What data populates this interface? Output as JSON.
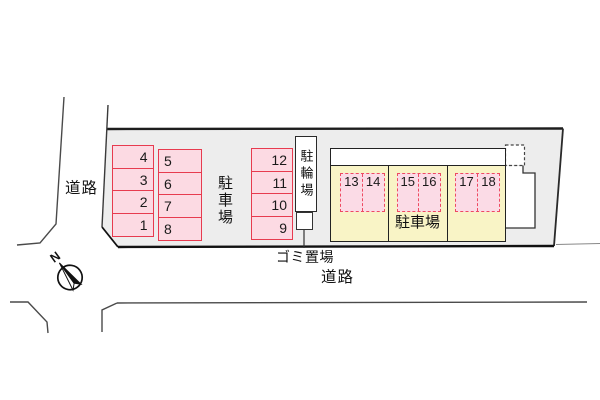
{
  "plan": {
    "road_label_left": "道路",
    "road_label_bottom": "道路",
    "main_parking_label": "駐車場",
    "building_parking_label": "駐車場",
    "bicycle_parking_label": "駐輪場",
    "garbage_area_label": "ゴミ置場",
    "compass_north": "N"
  },
  "spaces": {
    "col_a": [
      "4",
      "3",
      "2",
      "1"
    ],
    "col_b": [
      "5",
      "6",
      "7",
      "8"
    ],
    "col_c": [
      "12",
      "11",
      "10",
      "9"
    ],
    "building": [
      "13",
      "14",
      "15",
      "16",
      "17",
      "18"
    ]
  },
  "colors": {
    "site_fill": "#ededed",
    "stall_fill": "#fcdae3",
    "stall_border": "#e73b4f",
    "dashed_stall_border": "#ee4a62",
    "building_fill": "#f9f4c6",
    "outline": "#1d1d1d"
  }
}
